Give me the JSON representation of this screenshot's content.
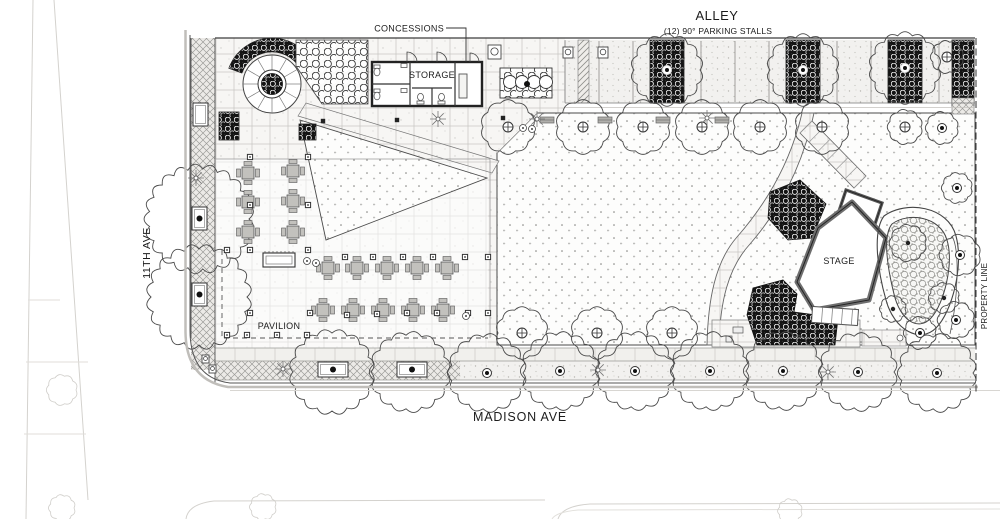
{
  "drawing": {
    "type": "architectural-site-plan",
    "labels": {
      "alley": "ALLEY",
      "parking_stalls": "(12) 90° PARKING STALLS",
      "concessions": "CONCESSIONS",
      "storage": "STORAGE",
      "stage": "STAGE",
      "pavilion": "PAVILION",
      "street_left": "11TH AVE",
      "street_bottom": "MADISON AVE",
      "property_line": "PROPERTY LINE"
    },
    "colors": {
      "paper": "#ffffff",
      "ink": "#1c1c1c",
      "linework": "#4a4a4a",
      "faint_context": "#d4d2ce",
      "dense_planting": "#141414",
      "furniture_gray": "#b0afab"
    }
  }
}
